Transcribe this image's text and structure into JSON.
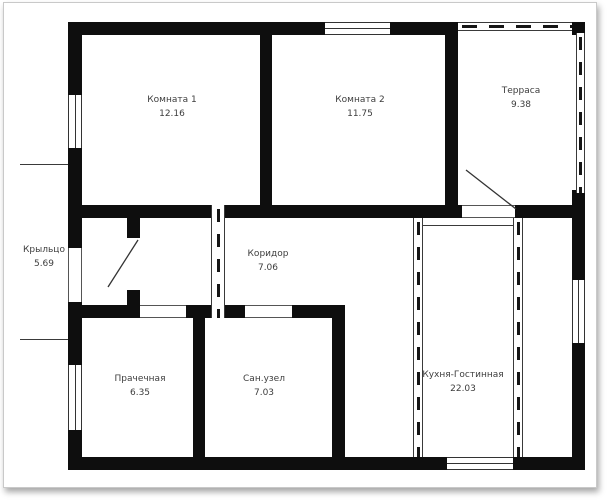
{
  "plan": {
    "type": "floor-plan",
    "language": "ru",
    "rooms": [
      {
        "name": "Комната 1",
        "area": "12.16"
      },
      {
        "name": "Комната 2",
        "area": "11.75"
      },
      {
        "name": "Терраса",
        "area": "9.38"
      },
      {
        "name": "Крыльцо",
        "area": "5.69"
      },
      {
        "name": "Коридор",
        "area": "7.06"
      },
      {
        "name": "Прачечная",
        "area": "6.35"
      },
      {
        "name": "Сан.узел",
        "area": "7.03"
      },
      {
        "name": "Кухня-Гостинная",
        "area": "22.03"
      }
    ],
    "colors": {
      "wall": "#0e0e0e",
      "background": "#ffffff",
      "frame_border": "#c9c9c9",
      "text": "#3d3d3d"
    }
  }
}
